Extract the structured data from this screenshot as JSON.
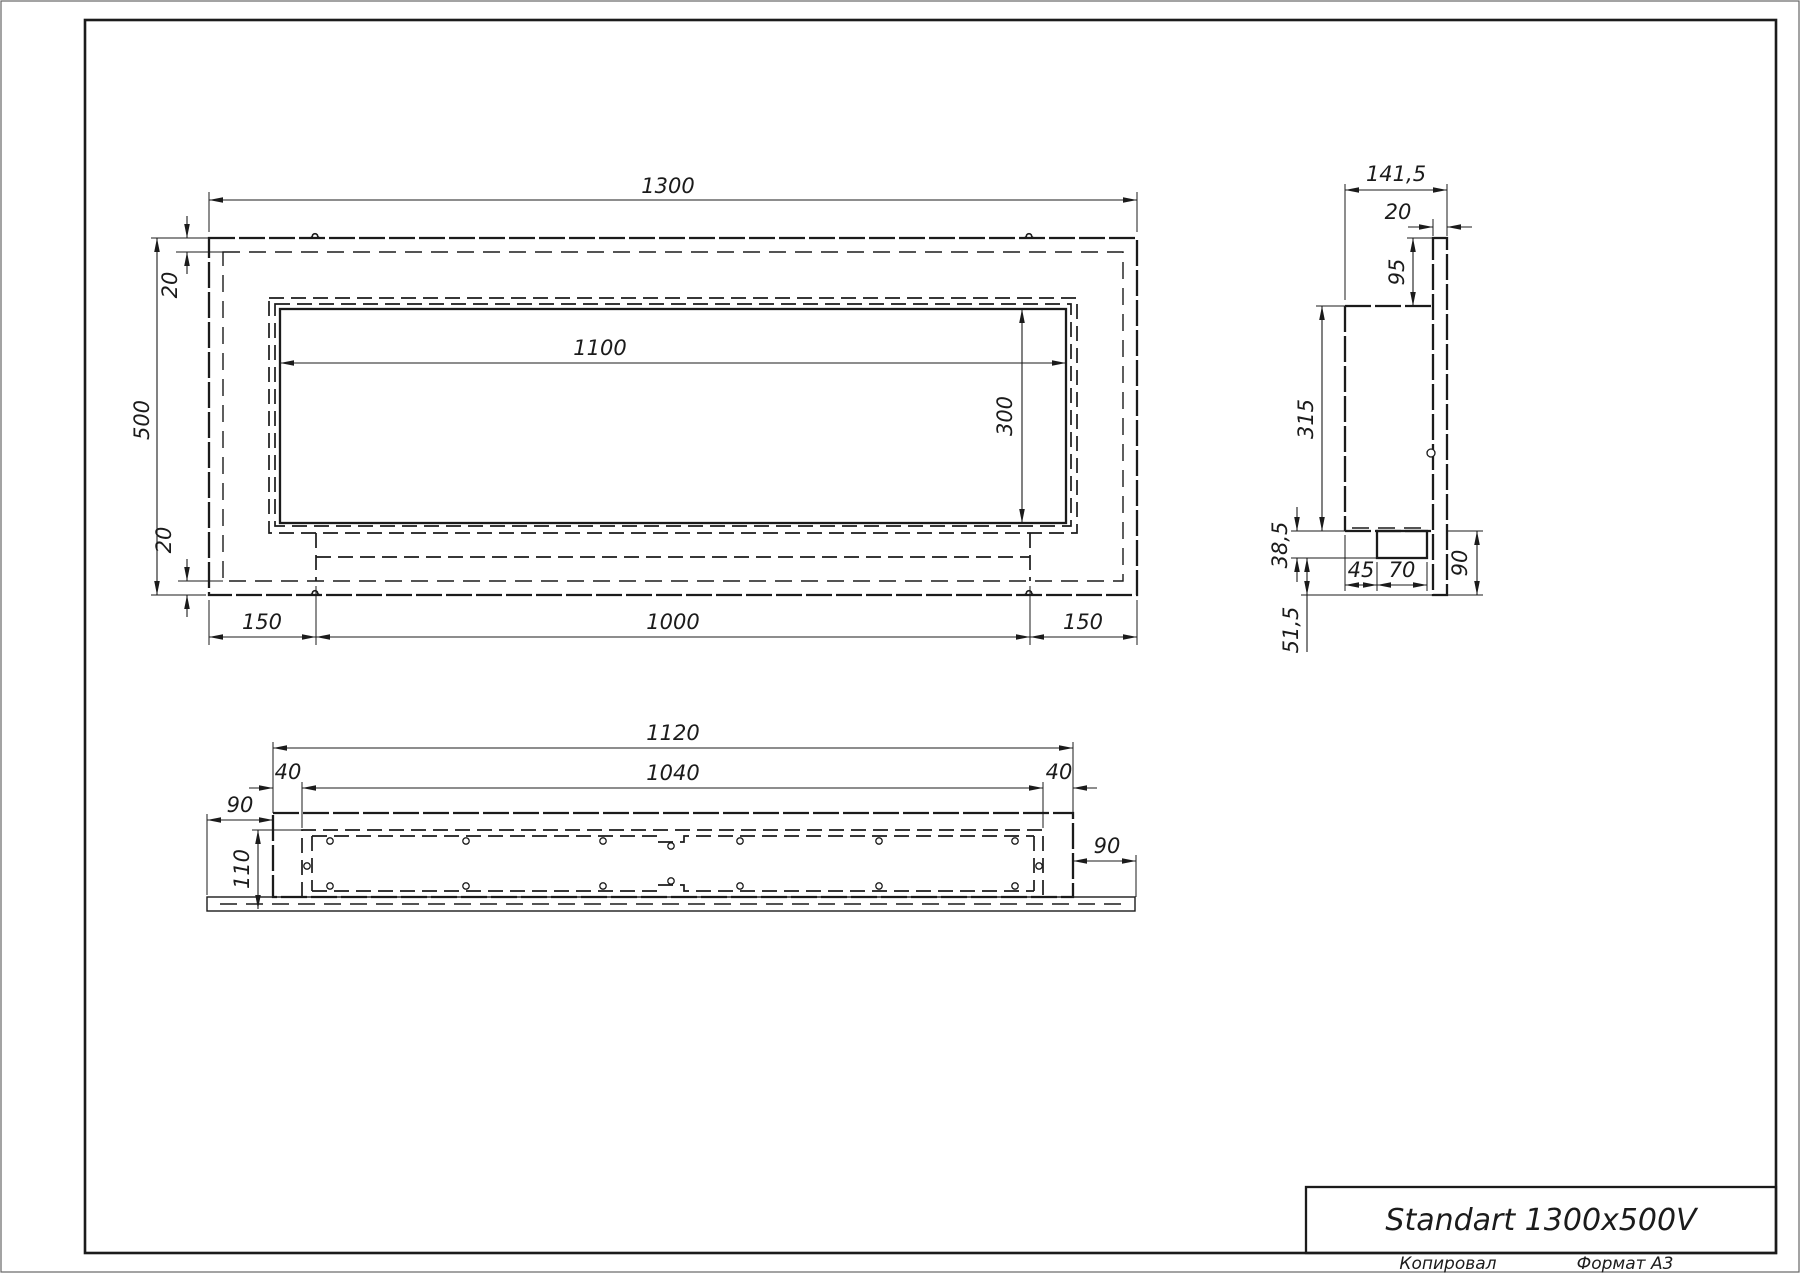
{
  "title_block": {
    "model": "Standart 1300x500V",
    "copied_label": "Копировал",
    "format_label": "Формат А3"
  },
  "front_view": {
    "dim_width": "1300",
    "dim_height": "500",
    "dim_top_inset": "20",
    "dim_bottom_inset": "20",
    "dim_opening_width": "1100",
    "dim_opening_height": "300",
    "dim_left_margin": "150",
    "dim_tray_width": "1000",
    "dim_right_margin": "150"
  },
  "side_view": {
    "dim_depth": "141,5",
    "dim_flange_thickness": "20",
    "dim_top_offset": "95",
    "dim_body_height": "315",
    "dim_block_drop": "38,5",
    "dim_bottom_offset": "51,5",
    "dim_block_inset": "45",
    "dim_block_width": "70",
    "dim_flange_below": "90"
  },
  "plan_view": {
    "dim_body_width": "1120",
    "dim_inner_width": "1040",
    "dim_end_left": "40",
    "dim_end_right": "40",
    "dim_overhang_left": "90",
    "dim_overhang_right": "90",
    "dim_depth": "110"
  }
}
